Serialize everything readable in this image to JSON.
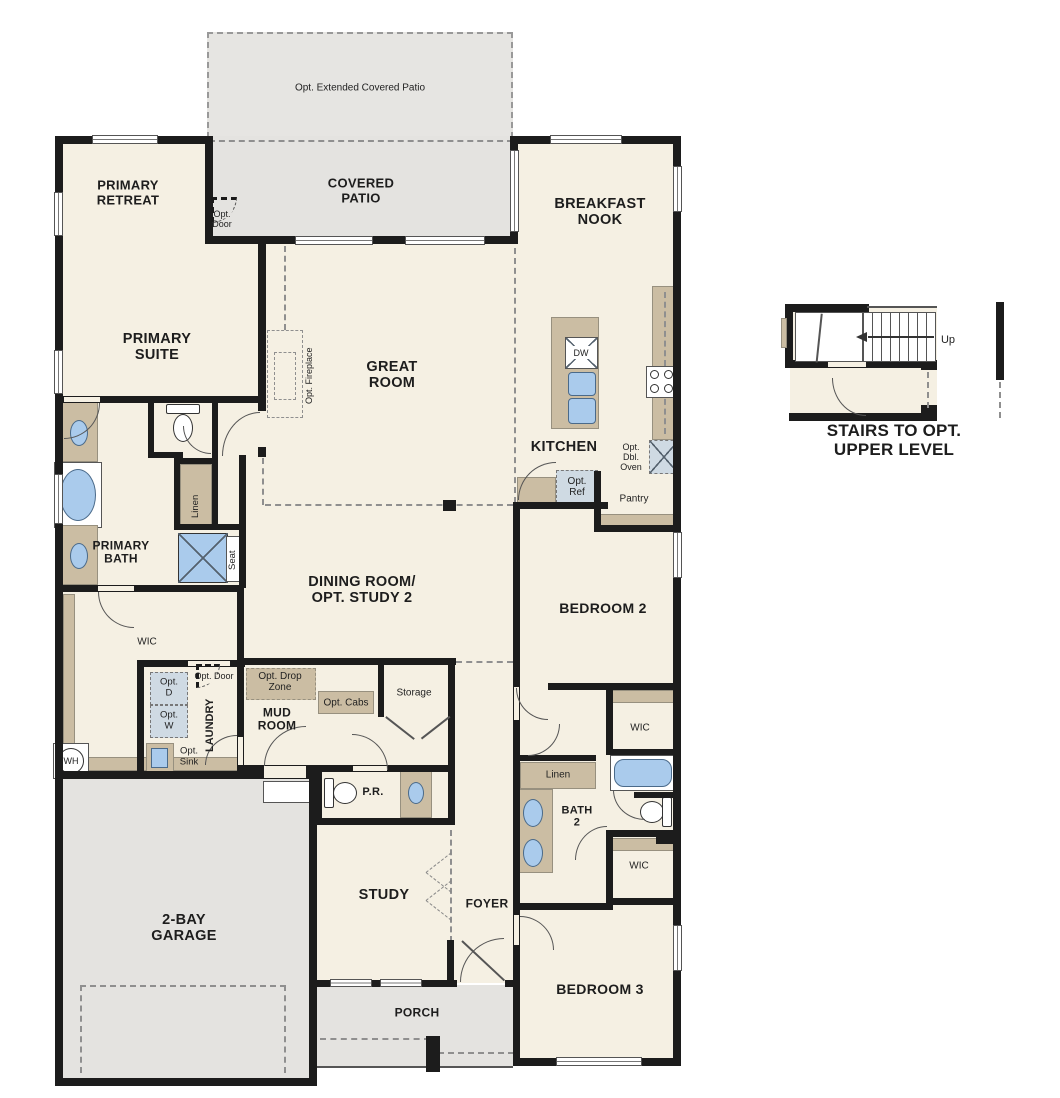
{
  "document": {
    "type": "single-story floor plan"
  },
  "colors": {
    "floor": "#f5f0e3",
    "outdoor_concrete": "#e4e3e0",
    "wall": "#1c1c1c",
    "cabinet_tan": "#cbbda3",
    "fixture_blue": "#aacbec",
    "optional_fill": "#cfdae3"
  },
  "rooms": {
    "opt_extended_patio": "Opt. Extended Covered Patio",
    "covered_patio": "COVERED\nPATIO",
    "primary_retreat": "PRIMARY\nRETREAT",
    "breakfast_nook": "BREAKFAST\nNOOK",
    "primary_suite": "PRIMARY\nSUITE",
    "great_room": "GREAT\nROOM",
    "kitchen": "KITCHEN",
    "dining_room": "DINING ROOM/\nOPT. STUDY 2",
    "primary_bath": "PRIMARY\nBATH",
    "wic_primary": "WIC",
    "laundry": "LAUNDRY",
    "mud_room": "MUD\nROOM",
    "powder_room": "P.R.",
    "bedroom_2": "BEDROOM 2",
    "bath_2": "BATH\n2",
    "wic_bedroom2": "WIC",
    "wic_bedroom3": "WIC",
    "bedroom_3": "BEDROOM 3",
    "garage": "2-BAY\nGARAGE",
    "study": "STUDY",
    "foyer": "FOYER",
    "porch": "PORCH",
    "pantry": "Pantry",
    "storage": "Storage"
  },
  "annotations": {
    "opt_door_patio": "Opt.\nDoor",
    "opt_fireplace": "Opt. Fireplace",
    "dishwasher": "DW",
    "opt_ref": "Opt.\nRef",
    "opt_dbl_oven": "Opt.\nDbl.\nOven",
    "linen_primary": "Linen",
    "seat": "Seat",
    "opt_door_laundry": "Opt. Door",
    "opt_dryer": "Opt.\nD",
    "opt_washer": "Opt.\nW",
    "opt_sink": "Opt.\nSink",
    "water_heater": "WH",
    "opt_drop_zone": "Opt. Drop\nZone",
    "opt_cabs": "Opt. Cabs",
    "linen_bath2": "Linen",
    "up": "Up"
  },
  "stairs_detail": {
    "caption": "STAIRS TO OPT. UPPER LEVEL"
  }
}
